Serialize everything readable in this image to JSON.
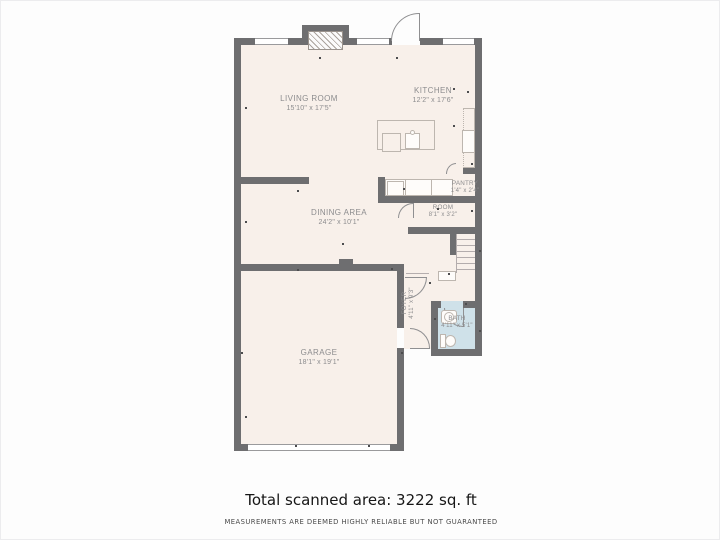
{
  "page": {
    "background": "#fdfdfd"
  },
  "floorplan": {
    "colors": {
      "wall": "#6e6e70",
      "floor": "#f8f0ea",
      "bath_floor": "#cfe1e9",
      "fixture_line": "#bdb6af",
      "label_text": "#8c8c8e"
    },
    "rooms": [
      {
        "name": "living-room",
        "label": "LIVING ROOM",
        "dims": "15'10\" x 17'5\""
      },
      {
        "name": "kitchen",
        "label": "KITCHEN",
        "dims": "12'2\" x 17'6\""
      },
      {
        "name": "dining-area",
        "label": "DINING AREA",
        "dims": "24'2\" x 10'1\""
      },
      {
        "name": "pantry",
        "label": "PANTRY",
        "dims": "1'4\" x 2'4\""
      },
      {
        "name": "room",
        "label": "ROOM",
        "dims": "8'1\" x 3'2\""
      },
      {
        "name": "foyer",
        "label": "FOYER",
        "dims": "4'11\" x 9'3\""
      },
      {
        "name": "bath",
        "label": "BATH",
        "dims": "4'11\" x 5'1\""
      },
      {
        "name": "garage",
        "label": "GARAGE",
        "dims": "18'1\" x 19'1\""
      }
    ],
    "scan_dots": [
      [
        244,
        106
      ],
      [
        318,
        56
      ],
      [
        395,
        56
      ],
      [
        452,
        87
      ],
      [
        466,
        90
      ],
      [
        296,
        189
      ],
      [
        244,
        220
      ],
      [
        341,
        242
      ],
      [
        296,
        268
      ],
      [
        390,
        267
      ],
      [
        452,
        124
      ],
      [
        470,
        162
      ],
      [
        402,
        187
      ],
      [
        436,
        207
      ],
      [
        470,
        209
      ],
      [
        478,
        249
      ],
      [
        428,
        281
      ],
      [
        447,
        272
      ],
      [
        464,
        302
      ],
      [
        433,
        317
      ],
      [
        478,
        329
      ],
      [
        294,
        444
      ],
      [
        367,
        444
      ],
      [
        240,
        351
      ],
      [
        400,
        351
      ],
      [
        244,
        415
      ]
    ]
  },
  "footer": {
    "total_area": "Total scanned area: 3222 sq. ft",
    "disclaimer": "MEASUREMENTS ARE DEEMED HIGHLY RELIABLE BUT NOT GUARANTEED"
  }
}
